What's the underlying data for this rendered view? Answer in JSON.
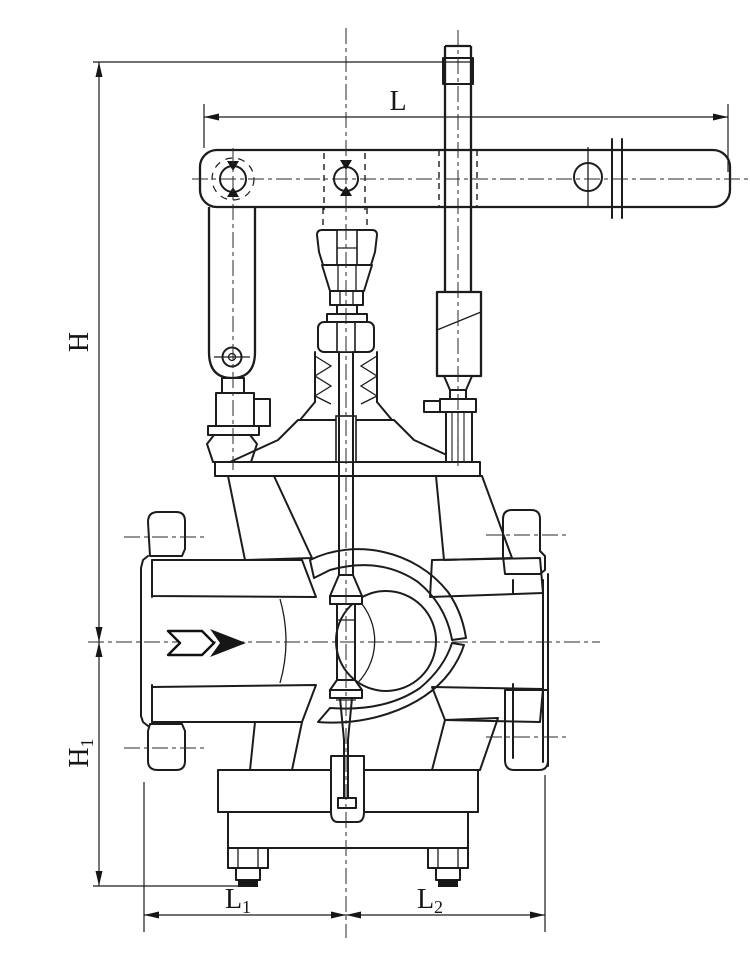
{
  "drawing": {
    "colors": {
      "ink": "#1c1c1c",
      "background": "#ffffff"
    },
    "dimension_labels": {
      "L": {
        "base": "L",
        "sub": ""
      },
      "H": {
        "base": "H",
        "sub": ""
      },
      "H1": {
        "base": "H",
        "sub": "1"
      },
      "L1": {
        "base": "L",
        "sub": "1"
      },
      "L2": {
        "base": "L",
        "sub": "2"
      }
    },
    "icons": {
      "flow_arrow": "flow-direction-arrow"
    }
  }
}
